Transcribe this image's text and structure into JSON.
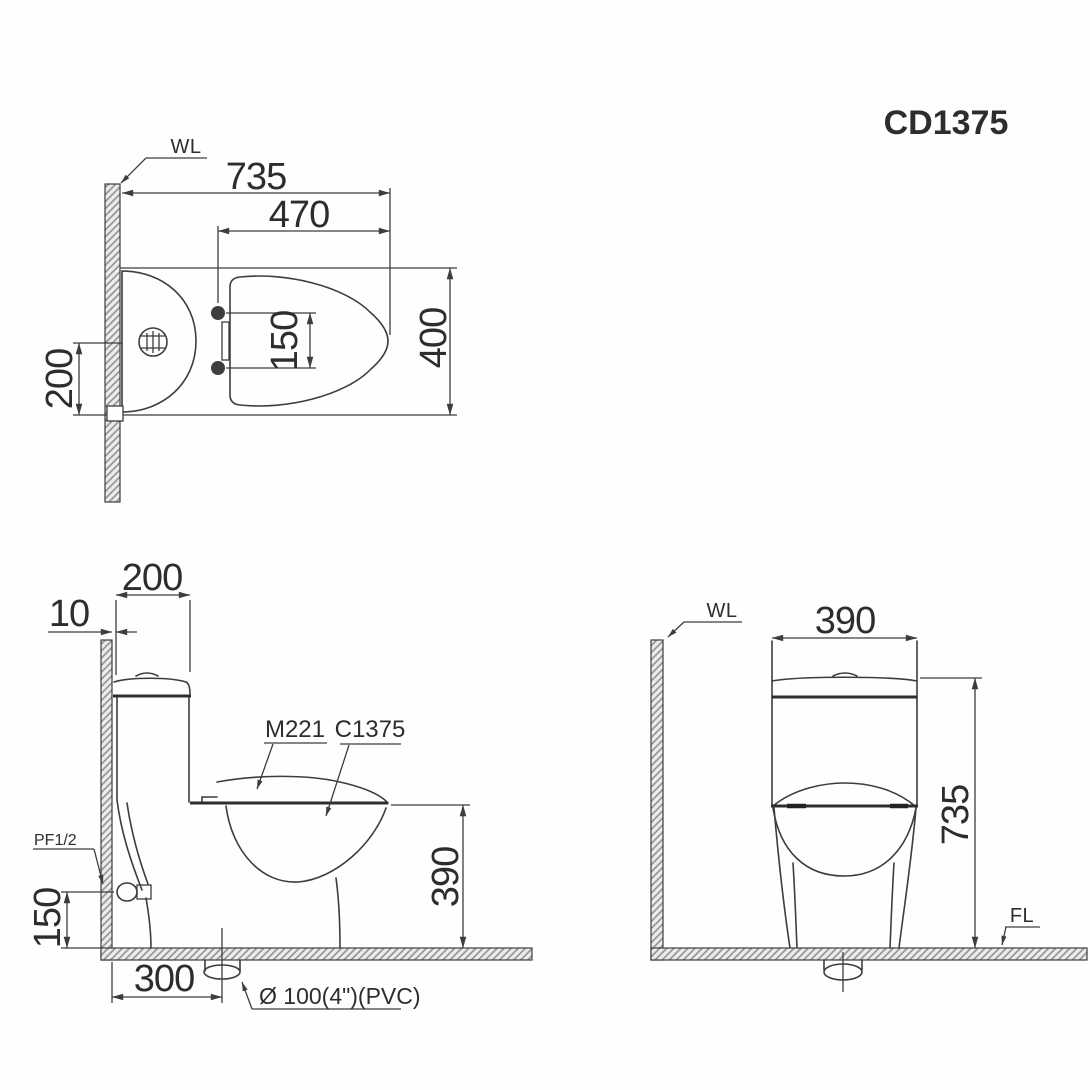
{
  "title": "CD1375",
  "colors": {
    "line": "#3d3d3d",
    "text": "#2d2d2d",
    "hatch_line": "#8f8f8f",
    "hatch_bg": "#ececec",
    "background": "#fefefe"
  },
  "top_view": {
    "wall_label": "WL",
    "dim_overall_depth": "735",
    "dim_seat_depth": "470",
    "dim_bolt_spacing": "150",
    "dim_overall_width": "400",
    "dim_supply_offset": "200"
  },
  "side_view": {
    "dim_tank_depth": "200",
    "dim_wall_gap": "10",
    "label_seat_model": "M221",
    "label_bowl_model": "C1375",
    "label_inlet": "PF1/2",
    "dim_inlet_height": "150",
    "dim_rim_height": "390",
    "dim_drain_setout": "300",
    "label_drain": "Ø 100(4\")(PVC)"
  },
  "front_view": {
    "wall_label": "WL",
    "floor_label": "FL",
    "dim_tank_width": "390",
    "dim_overall_height": "735"
  }
}
